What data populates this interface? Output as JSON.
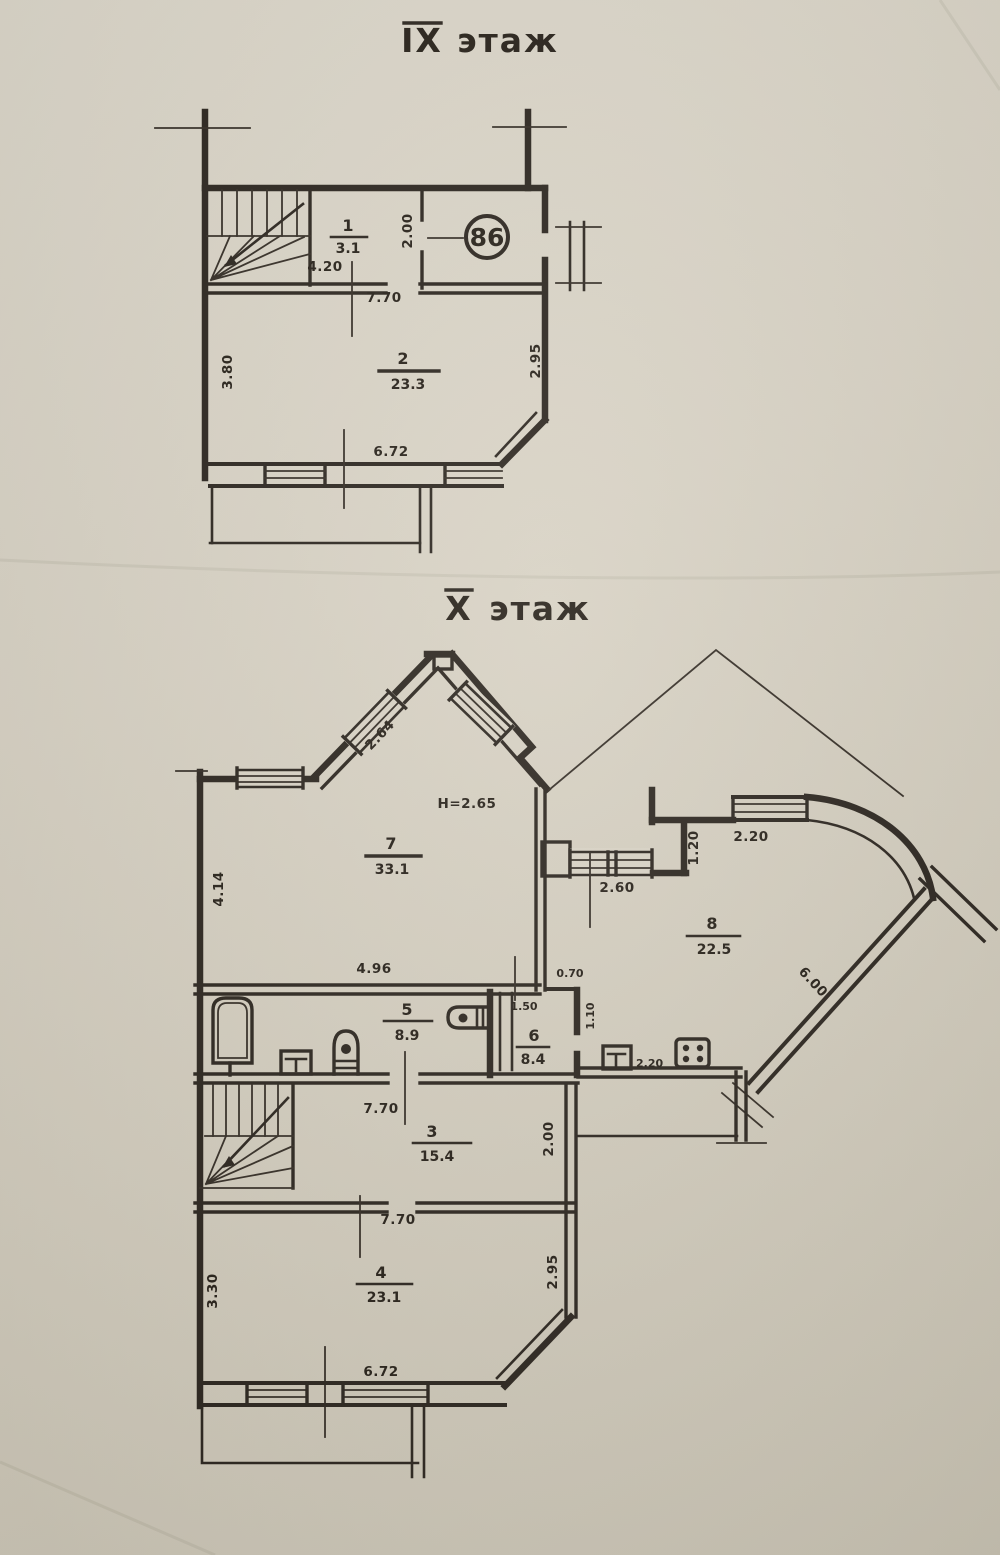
{
  "ink_color": "#2c261f",
  "paper_color": "#d8d2c4",
  "floors": {
    "upper": {
      "title_roman": "IX",
      "title_word": "этаж",
      "apartment_number": "86",
      "rooms": [
        {
          "number": "1",
          "area": "3.1"
        },
        {
          "number": "2",
          "area": "23.3"
        }
      ],
      "dims": {
        "room1_width": "4.20",
        "hall_width": "7.70",
        "room1_depth": "2.00",
        "left_height": "3.80",
        "right_height": "2.95",
        "bottom_width": "6.72"
      }
    },
    "lower": {
      "title_roman": "X",
      "title_word": "этаж",
      "height_note": "H=2.65",
      "rooms": [
        {
          "number": "3",
          "area": "15.4"
        },
        {
          "number": "4",
          "area": "23.1"
        },
        {
          "number": "5",
          "area": "8.9"
        },
        {
          "number": "6",
          "area": "8.4"
        },
        {
          "number": "7",
          "area": "33.1"
        },
        {
          "number": "8",
          "area": "22.5"
        }
      ],
      "dims": {
        "gable_window": "2.64",
        "bay_width": "2.60",
        "niche_depth": "1.20",
        "terrace_window": "2.20",
        "left_upper_height": "4.14",
        "bath_width": "4.96",
        "duct_width": "0.70",
        "wc_width": "1.50",
        "wc_depth": "1.10",
        "kitchen_dim": "2.20",
        "corridor_length": "6.00",
        "hall_top_width": "7.70",
        "hall_bottom_width": "7.70",
        "hall_depth": "2.00",
        "left_lower_height": "3.30",
        "room4_right_height": "2.95",
        "bottom_width": "6.72"
      }
    }
  }
}
